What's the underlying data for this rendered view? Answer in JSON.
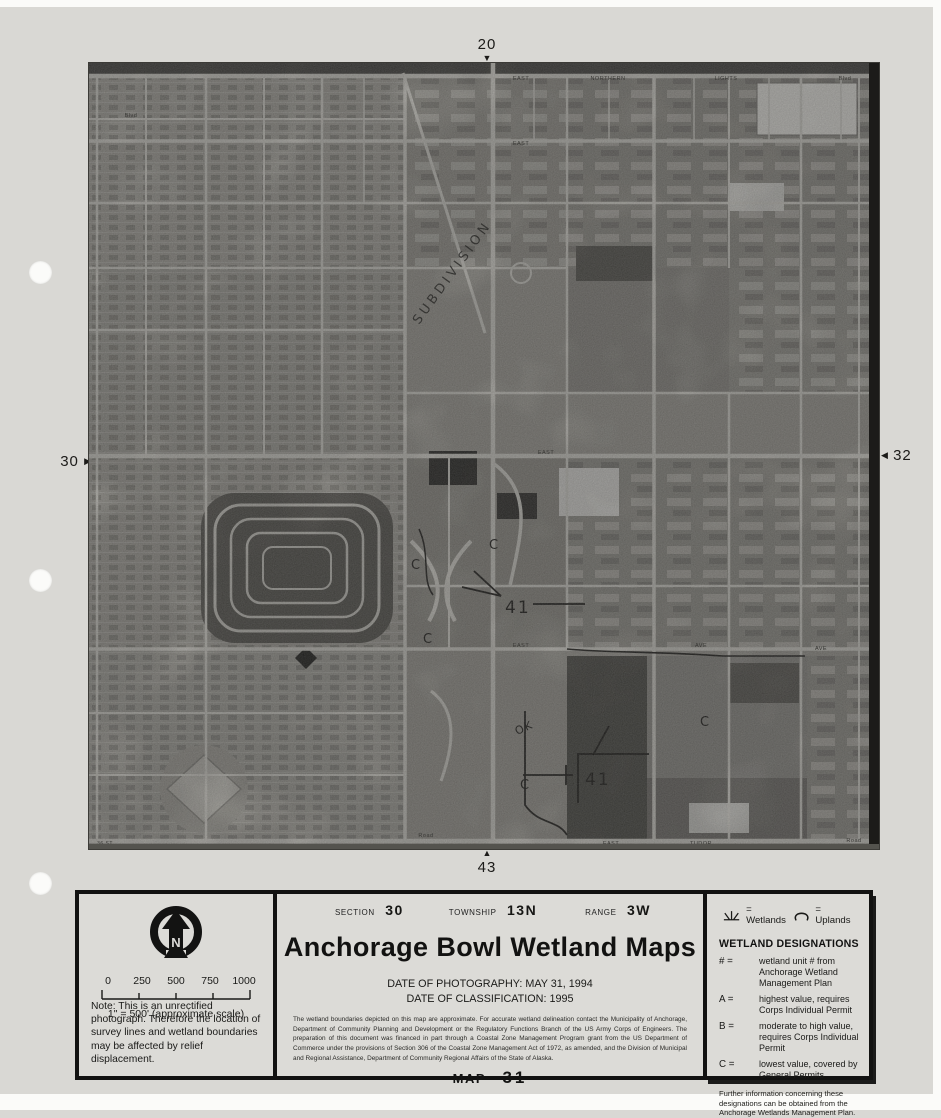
{
  "icons": {
    "arrow_right": "▶",
    "arrow_left": "◀",
    "arrow_up": "▲",
    "arrow_down": "▼"
  },
  "map": {
    "edge_markers": {
      "top": "20",
      "left": "30",
      "right": "32",
      "bottom": "43"
    },
    "roads": {
      "northern_lights": {
        "east": "EAST",
        "northern": "NORTHERN",
        "lights": "LIGHTS",
        "blvd": "Blvd"
      },
      "second": {
        "blvd": "Blvd",
        "east": "EAST"
      },
      "mid": {
        "east": "EAST"
      },
      "lower": {
        "east": "EAST",
        "ave1": "AVE",
        "ave2": "AVE"
      },
      "tudor": {
        "st36": "36 ST",
        "road1": "Road",
        "east": "EAST",
        "tudor": "TUDOR",
        "road2": "Road"
      }
    },
    "annotations": {
      "subdivision": "SUBDIVISION",
      "ok": "OK",
      "unit_a": "41",
      "unit_b": "41",
      "c_marks": [
        "C",
        "C",
        "C",
        "C",
        "C"
      ]
    }
  },
  "legend": {
    "north_label": "N",
    "scale": {
      "ticks": [
        "0",
        "250",
        "500",
        "750",
        "1000"
      ],
      "caption": "1\" = 500' (approximate scale)"
    },
    "note": "Note:  This is an unrectified photograph.  Therefore the location of survey lines and wetland boundaries may be affected by relief displacement.",
    "header": {
      "section_label": "SECTION",
      "section_value": "30",
      "township_label": "TOWNSHIP",
      "township_value": "13N",
      "range_label": "RANGE",
      "range_value": "3W"
    },
    "title": "Anchorage Bowl Wetland Maps",
    "date_photography": "DATE OF PHOTOGRAPHY:  MAY 31, 1994",
    "date_classification": "DATE OF CLASSIFICATION:  1995",
    "disclaimer": "The wetland boundaries depicted on this map are approximate.  For accurate wetland delineation contact the Municipality of Anchorage, Department of Community Planning and Development or the Regulatory Functions Branch of the US Army Corps of Engineers.  The preparation of this document was financed in part through a Coastal Zone Management Program grant from the US Department of Commerce under the provisions of Section 306 of the Coastal Zone Management Act of 1972, as amended, and the Division of Municipal and Regional Assistance, Department of Community Regional Affairs of the State of Alaska.",
    "map_label": "MAP",
    "map_number": "31",
    "symbols": {
      "wetlands": "=  Wetlands",
      "uplands": "=  Uplands"
    },
    "designations_title": "WETLAND DESIGNATIONS",
    "designations": [
      {
        "key": "# =",
        "desc": "wetland unit # from Anchorage Wetland Management Plan"
      },
      {
        "key": "A =",
        "desc": "highest value, requires Corps Individual Permit"
      },
      {
        "key": "B =",
        "desc": "moderate to high value, requires Corps Individual Permit"
      },
      {
        "key": "C =",
        "desc": "lowest value, covered by General Permits"
      }
    ],
    "footer": "Further information concerning these designations can be obtained from the Anchorage Wetlands Management Plan."
  }
}
